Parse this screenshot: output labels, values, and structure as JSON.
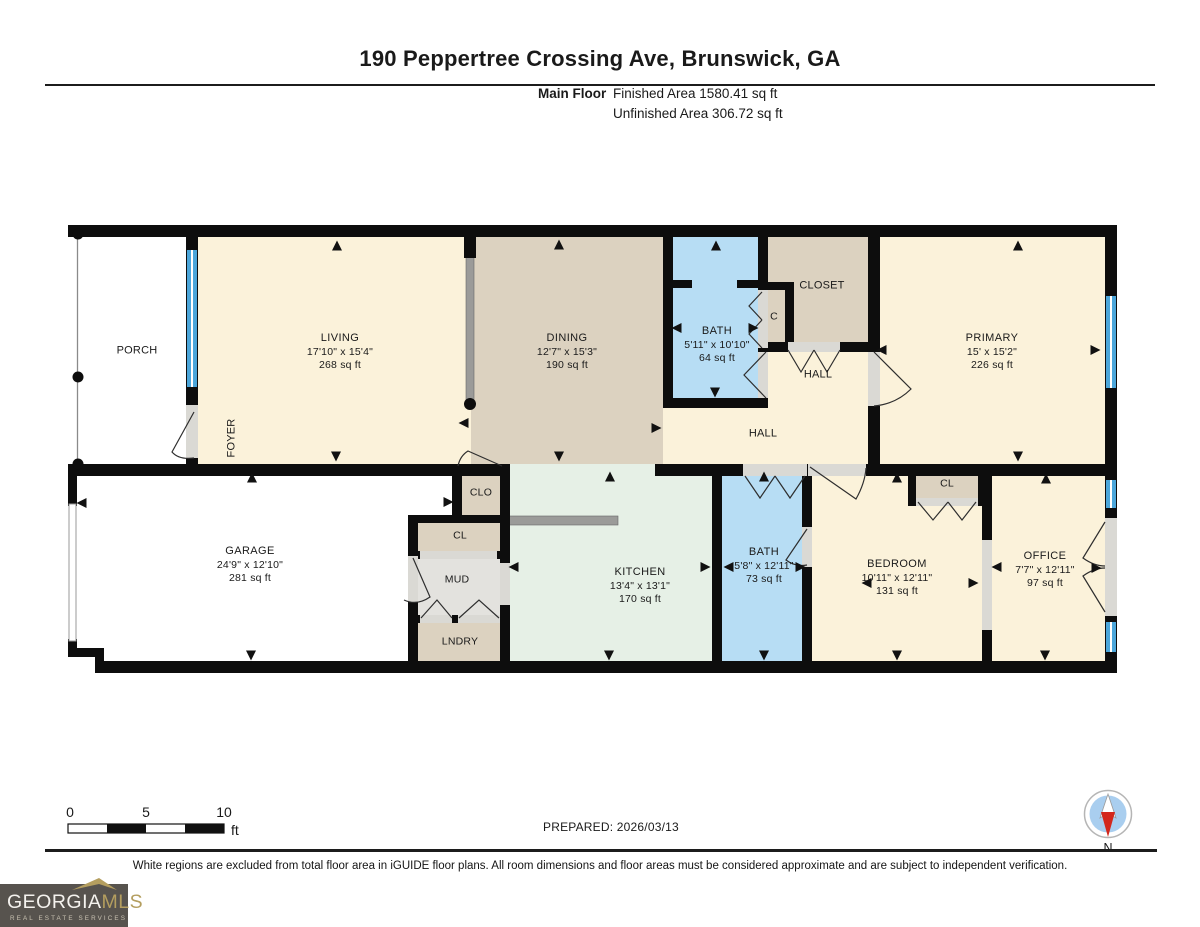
{
  "header": {
    "title": "190 Peppertree Crossing Ave, Brunswick, GA",
    "floor_label": "Main Floor",
    "finished_area": "Finished Area 1580.41 sq ft",
    "unfinished_area": "Unfinished Area 306.72 sq ft"
  },
  "rooms": {
    "living": {
      "name": "LIVING",
      "dims": "17'10\" x 15'4\"",
      "area": "268 sq ft"
    },
    "dining": {
      "name": "DINING",
      "dims": "12'7\" x 15'3\"",
      "area": "190 sq ft"
    },
    "bath1": {
      "name": "BATH",
      "dims": "5'11\" x 10'10\"",
      "area": "64 sq ft"
    },
    "primary": {
      "name": "PRIMARY",
      "dims": "15' x 15'2\"",
      "area": "226 sq ft"
    },
    "garage": {
      "name": "GARAGE",
      "dims": "24'9\" x 12'10\"",
      "area": "281 sq ft"
    },
    "kitchen": {
      "name": "KITCHEN",
      "dims": "13'4\" x 13'1\"",
      "area": "170 sq ft"
    },
    "bath2": {
      "name": "BATH",
      "dims": "5'8\" x 12'11\"",
      "area": "73 sq ft"
    },
    "bedroom": {
      "name": "BEDROOM",
      "dims": "10'11\" x 12'11\"",
      "area": "131 sq ft"
    },
    "office": {
      "name": "OFFICE",
      "dims": "7'7\" x 12'11\"",
      "area": "97 sq ft"
    },
    "porch": "PORCH",
    "foyer": "FOYER",
    "closet": "CLOSET",
    "c": "C",
    "hall_upper": "HALL",
    "hall_main": "HALL",
    "clo": "CLO",
    "cl": "CL",
    "mud": "MUD",
    "lndry": "LNDRY",
    "cl2": "CL"
  },
  "footer": {
    "scale": {
      "tick0": "0",
      "tick5": "5",
      "tick10": "10",
      "unit": "ft"
    },
    "prepared": "PREPARED: 2026/03/13",
    "compass_label": "N",
    "disclaimer": "White regions are excluded from total floor area in iGUIDE floor plans. All room dimensions and floor areas must be considered approximate and are subject to independent verification."
  },
  "logo": {
    "brand_a": "GEORGIA",
    "brand_b": "MLS",
    "tagline": "REAL ESTATE SERVICES"
  },
  "colors": {
    "room-cream": "#FBF2DA",
    "room-tan": "#DCD2C0",
    "room-mint": "#E6F0E6",
    "room-blue": "#B7DDF4",
    "room-gray": "#E3E2DE",
    "wall": "#0D0D0D",
    "window-blue": "#4BA6DA",
    "opening": "#DAD9D4",
    "counter": "#9B9B99",
    "logo-bg": "#57534E",
    "logo-gold": "#B49E5F",
    "compass-blue": "#A9CEEF",
    "compass-red": "#D3271C"
  }
}
